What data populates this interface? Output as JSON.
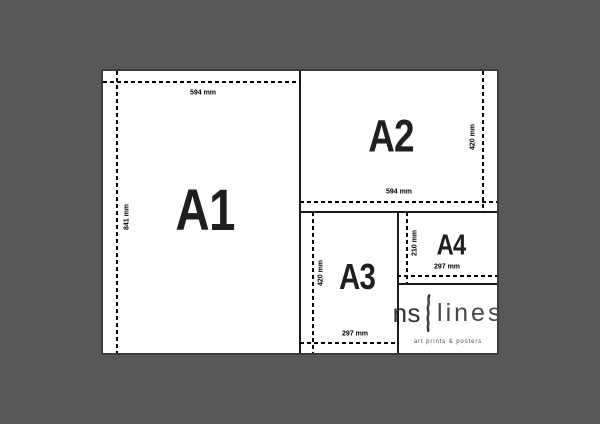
{
  "diagram": {
    "title": "paper size comparison",
    "sheets": [
      {
        "name": "A1",
        "label": "A1",
        "width_label": "594 mm",
        "height_label": "841 mm"
      },
      {
        "name": "A2",
        "label": "A2",
        "width_label": "594 mm",
        "height_label": "420 mm"
      },
      {
        "name": "A3",
        "label": "A3",
        "width_label": "297 mm",
        "height_label": "420 mm"
      },
      {
        "name": "A4",
        "label": "A4",
        "width_label": "297 mm",
        "height_label": "210 mm"
      }
    ],
    "logo": {
      "name_left": "ns",
      "name_right": "lines",
      "tagline": "art prints & posters",
      "icon": "brush-stroke-icon"
    },
    "colors": {
      "background": "#58585a",
      "canvas": "#ffffff",
      "line": "#000000",
      "sheet_label_text": "#221e1f",
      "logo_text": "#333336"
    }
  }
}
